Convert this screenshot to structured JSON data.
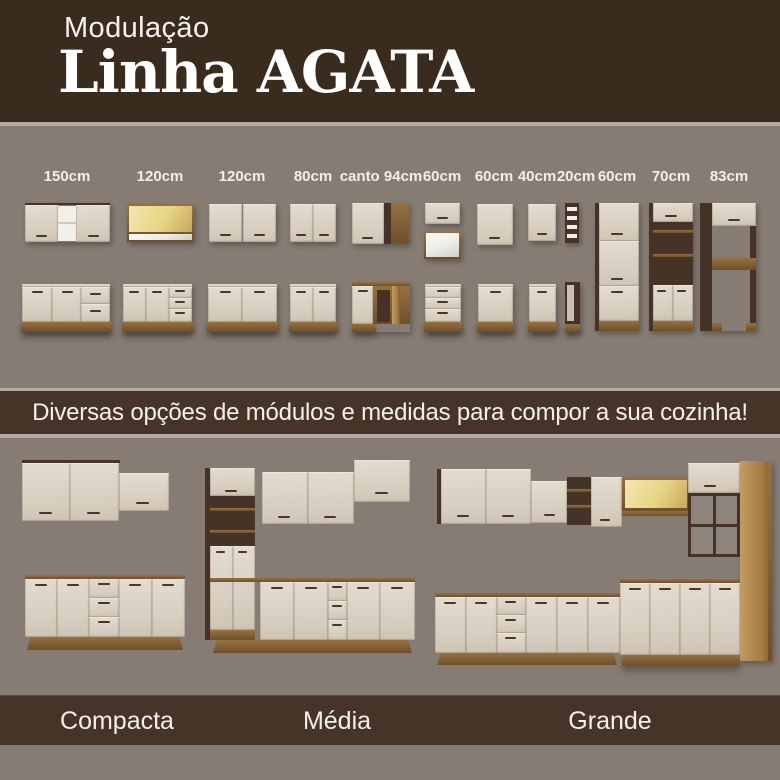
{
  "header": {
    "kicker": "Modulação",
    "title": "Linha AGATA"
  },
  "modules": {
    "labels": [
      "150cm",
      "120cm",
      "120cm",
      "80cm",
      "canto 94cm",
      "60cm",
      "60cm",
      "40cm",
      "20cm",
      "60cm",
      "70cm",
      "83cm"
    ]
  },
  "divider": {
    "text": "Diversas opções de módulos e medidas para compor a sua cozinha!"
  },
  "kitchens": {
    "labels": [
      "Compacta",
      "Média",
      "Grande"
    ]
  },
  "colors": {
    "header_brown": "#3A2B1F",
    "band_brown": "#463428",
    "background_taupe": "#867C73",
    "separator_gray": "#B2ABA3",
    "cabinet_cream": "#D9D1C5",
    "wood": "#7B5B39",
    "glass_yellow": "#E6D584",
    "text_white": "#F5F1EA"
  }
}
